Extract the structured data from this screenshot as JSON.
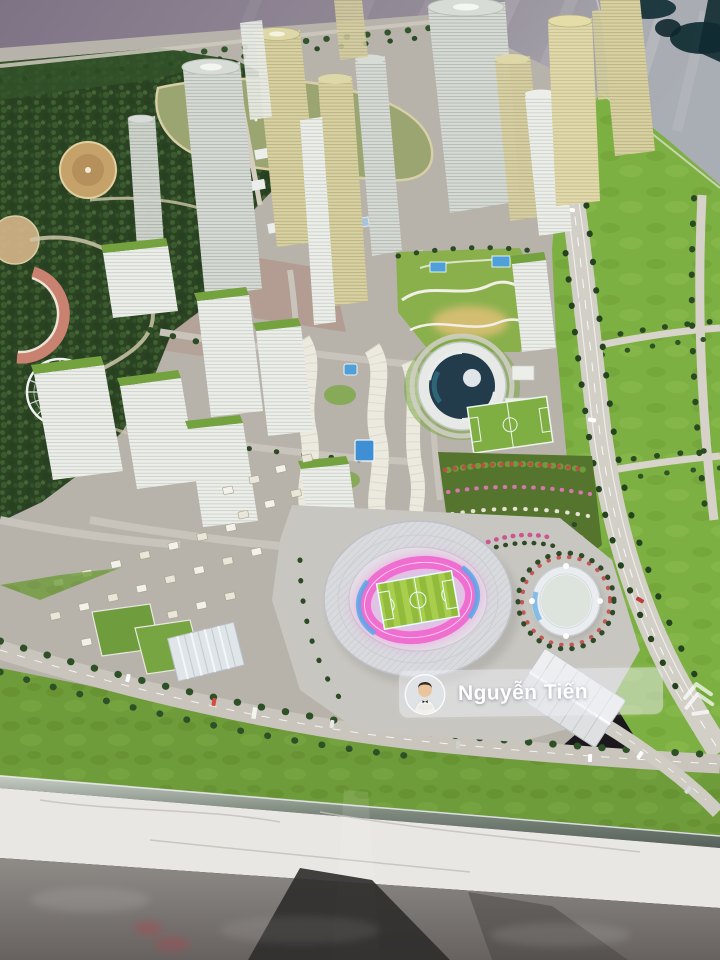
{
  "meta": {
    "type": "photograph",
    "subject": "High-angle photo of an illuminated architectural scale model of a new urban district: golden skyscraper cluster, park with lake and ferris wheel, white residential slabs with green roofs, circular landmark building, flower gardens, curved expressway across green fields, and a central oval stadium with glowing pink running track and striped football pitch, displayed on a table over a marble showroom floor with reflections."
  },
  "watermark": {
    "name": "Nguyễn Tiến",
    "avatar_alt": "portrait of a young man in a white suit with dark bow tie",
    "logo_alt": "layered chevron house logo"
  },
  "colors": {
    "floor_mauve": "#8e8292",
    "tower_gold": "#d8d1a2",
    "tower_silver": "#d7dbd5",
    "park_green": "#2b4323",
    "lake_green": "#9aa571",
    "field_green": "#7db042",
    "lawn_green": "#6f9c3a",
    "road_gray": "#c9c5bd",
    "stadium_shell": "#d9dade",
    "track_pink": "#ef6fd0",
    "track_blue": "#58a8e8",
    "pitch_green": "#a9cd4c",
    "pool_blue": "#3f8fd4",
    "marble": "#e9e7e3",
    "reflection_dark": "#2e2c2a"
  },
  "scene": {
    "regions": [
      {
        "name": "park-with-lake",
        "label": "wooded park, lake, ferris wheel, amphitheater"
      },
      {
        "name": "skyscraper-cluster",
        "label": "golden and silver high-rise towers"
      },
      {
        "name": "residential-slabs",
        "label": "white apartment slabs with green roofs"
      },
      {
        "name": "townhouse-rows",
        "label": "curved shophouse rows with swimming pool"
      },
      {
        "name": "circular-landmark",
        "label": "round building with spiral glass roof"
      },
      {
        "name": "flower-garden",
        "label": "multicolored flower parterre"
      },
      {
        "name": "expressway",
        "label": "curved highway across green fields"
      },
      {
        "name": "stadium",
        "label": "oval stadium, pink track, striped pitch"
      },
      {
        "name": "small-arena",
        "label": "small oval arena with blue glow"
      },
      {
        "name": "expo-hall",
        "label": "white ridged-roof hall"
      },
      {
        "name": "showroom-floor",
        "label": "marble floor with model reflections"
      }
    ]
  }
}
